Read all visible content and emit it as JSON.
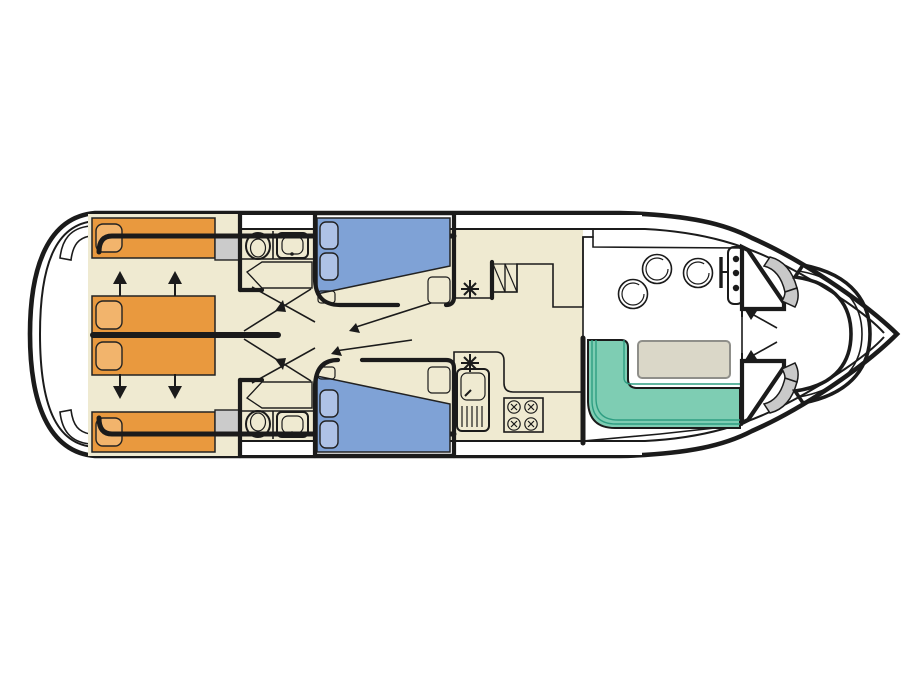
{
  "diagram": {
    "kind": "boat-deck-floorplan",
    "orientation": "bow-right-stern-left"
  },
  "colors": {
    "background": "#FFFFFF",
    "outline": "#1B1B1B",
    "floor": "#EFEAD1",
    "counter": "#D9D5BE",
    "bed_orange": "#E9993E",
    "pillow_orange": "#F2B46C",
    "bed_blue": "#7FA2D6",
    "pillow_blue": "#AEC2E6",
    "sofa_green": "#7ECDB3",
    "sofa_seam": "#2E9E82",
    "stool_pink": "#E7C3D3",
    "table_grey": "#DAD7C8",
    "table_edge": "#8F8F8A",
    "console_grey": "#C2C2C2",
    "cabinet_grey": "#CBCBCB",
    "step_grey": "#C9C9C9",
    "white_fixture": "#FFFFFF"
  },
  "plan": {
    "aft_cabins": {
      "single_beds": 4,
      "pillows": 4,
      "slide_arrows_up": 2,
      "slide_arrows_down": 2,
      "wardrobes": 2
    },
    "bathrooms": {
      "count": 2,
      "fixtures_each": [
        "toilet",
        "washbasin",
        "shower"
      ]
    },
    "mid_cabins": {
      "double_beds": 2,
      "pillows_each": 2,
      "door_swings": 2
    },
    "galley": {
      "stove_burners": 4,
      "sink_with_drainer": 1,
      "companionway_steps": 2,
      "vent_symbols": 2
    },
    "saloon": {
      "stools": 3,
      "table": 1,
      "l_shaped_sofa": 1
    },
    "helm": {
      "instrument_lights": 3,
      "steering_wheel": 1
    },
    "bow": {
      "curved_bench": 1,
      "step_flights": 2,
      "entry_arrows": 2
    },
    "stern": {
      "swim_platform": 1,
      "boarding_steps": 2
    }
  }
}
